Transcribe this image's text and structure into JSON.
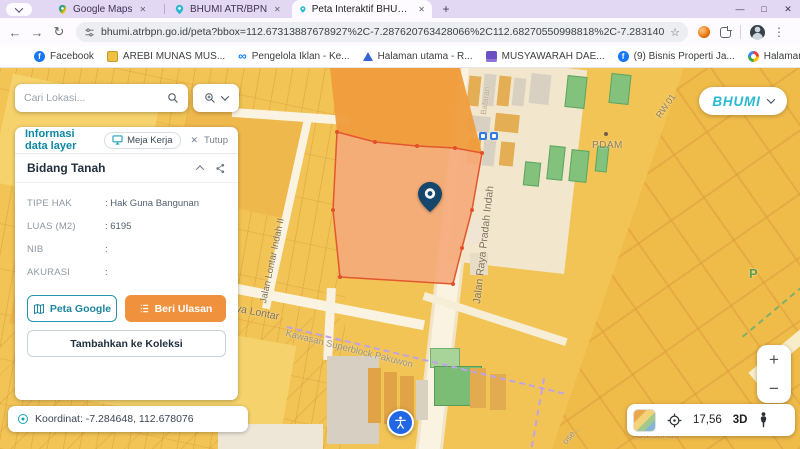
{
  "browser": {
    "tabs": [
      {
        "title": "Google Maps"
      },
      {
        "title": "BHUMI ATR/BPN"
      },
      {
        "title": "Peta Interaktif BHUMI ATR/BPN"
      }
    ],
    "tab_close": "✕",
    "new_tab": "+",
    "window_controls": {
      "minimize": "—",
      "maximize": "□",
      "close": "✕"
    },
    "toolbar": {
      "back": "←",
      "forward": "→",
      "reload": "↻",
      "bookmark_star": "☆",
      "menu": "⋮"
    },
    "url": "bhumi.atrbpn.go.id/peta?bbox=112.67313887678927%2C-7.287620763428066%2C112.68270550998818%2C-7.283140043732985&height=645&width=1366...",
    "bookmarks": [
      {
        "label": "Facebook"
      },
      {
        "label": "AREBI MUNAS MUS..."
      },
      {
        "label": "Pengelola Iklan - Ke..."
      },
      {
        "label": "Halaman utama - R..."
      },
      {
        "label": "MUSYAWARAH DAE..."
      },
      {
        "label": "(9) Bisnis Properti Ja..."
      },
      {
        "label": "Halaman utama - R..."
      }
    ],
    "all_bookmarks": "Semua Bookmark"
  },
  "search": {
    "placeholder": "Cari Lokasi..."
  },
  "panel": {
    "title": "Informasi data layer",
    "workspace_button": "Meja Kerja",
    "close_x": "✕",
    "close_button": "Tutup",
    "section": "Bidang Tanah",
    "fields": [
      {
        "label": "TIPE HAK",
        "value": ": Hak Guna Bangunan"
      },
      {
        "label": "LUAS (M2)",
        "value": ": 6195"
      },
      {
        "label": "NIB",
        "value": ":"
      },
      {
        "label": "AKURASI",
        "value": ":"
      }
    ],
    "peta_google": "Peta Google",
    "beri_ulasan": "Beri Ulasan",
    "tambah_koleksi": "Tambahkan ke Koleksi"
  },
  "status": {
    "coordinates": "Koordinat: -7.284648, 112.678076"
  },
  "map": {
    "logo": "BHUMI",
    "labels": {
      "road_main": "Jalan Raya Pradah Indah",
      "road_side": "Jalan Lontar Indah II",
      "road_lontar": "Raya Lontar",
      "kawasan": "Kawasan Superblock Pakuwon",
      "pdam": "PDAM",
      "rw": "RW.01",
      "parking": "P",
      "bataran": "Bataran",
      "carsendo": "Carsendo",
      "ose": "ose.."
    },
    "controls": {
      "zoom_in": "+",
      "zoom_out": "−",
      "zoom_level": "17,56",
      "mode_3d": "3D"
    }
  },
  "colors": {
    "accent_teal": "#18a2b8",
    "accent_orange": "#f0913d",
    "parcel_fill": "#f5aa7b",
    "parcel_border": "#e2572e",
    "map_base": "#f2c455",
    "pin_navy": "#15466b",
    "accessibility_blue": "#2166e3"
  }
}
